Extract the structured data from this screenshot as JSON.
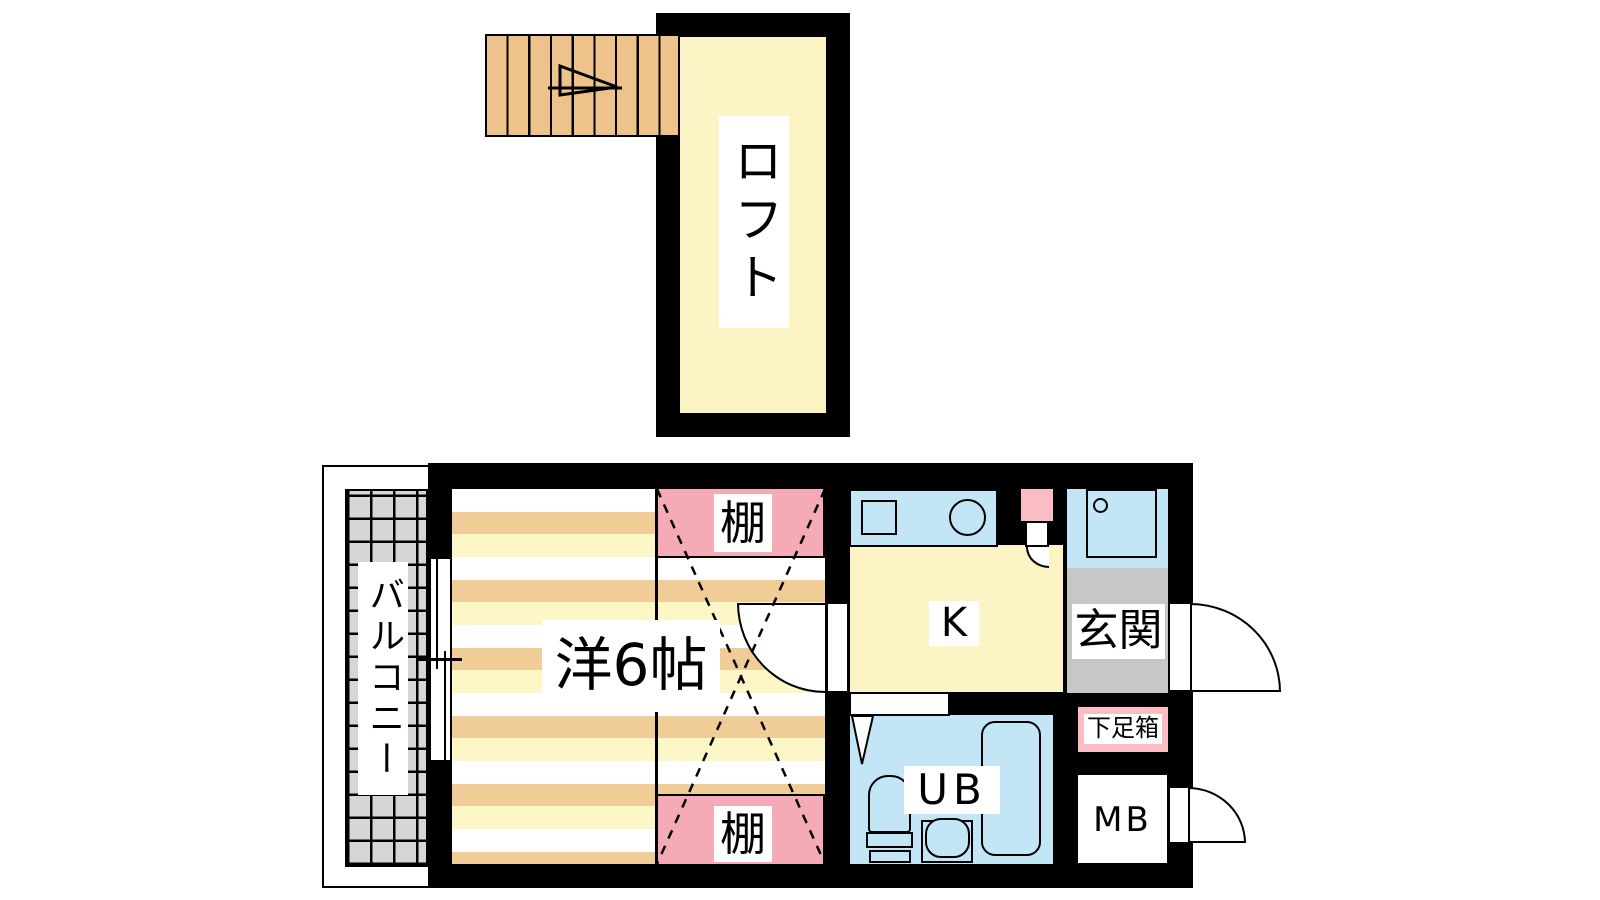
{
  "plan_title": "1K loft apartment floor plan",
  "rooms": {
    "loft": {
      "label": "ロフト"
    },
    "western_room": {
      "label": "洋6帖"
    },
    "balcony": {
      "label": "バルコニー"
    },
    "kitchen": {
      "label": "K"
    },
    "entrance": {
      "label": "玄関"
    },
    "unit_bath": {
      "label": "UB"
    },
    "meter_box": {
      "label": "MB"
    },
    "shoe_box": {
      "label": "下足箱"
    },
    "shelf_top": {
      "label": "棚"
    },
    "shelf_bottom": {
      "label": "棚"
    }
  },
  "colors": {
    "wall": "#000000",
    "page_bg": "#ffffff",
    "pale_yellow": "#fcf4c4",
    "stripe_orange": "#f0cc96",
    "stripe_yellow": "#fdf6c6",
    "stairs_tan": "#eec38b",
    "balcony_tile": "#d6d6d6",
    "entrance_gray": "#c7c7c7",
    "shelf_pink": "#f4abb5",
    "shoebox_pink": "#f9bdc3",
    "fixture_blue": "#c3e6f7"
  }
}
